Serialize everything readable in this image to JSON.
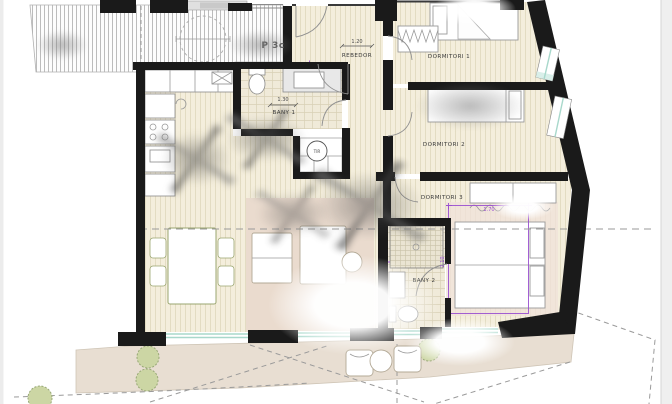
{
  "plan": {
    "unit_label": "P 3c",
    "labels": {
      "rebedor": "REBEDOR",
      "dormitori1": "DORMITORI 1",
      "dormitori2": "DORMITORI 2",
      "dormitori3": "DORMITORI 3",
      "bany1": "BANY 1",
      "bany2": "BANY 2",
      "tir": "TIR"
    },
    "dimensions": {
      "rebedor_window": "1.20",
      "bany1_width": "1.30",
      "dorm3_width": "1.70",
      "dorm3_depth": "2.10"
    }
  },
  "colors": {
    "wall": "#1a1a1a",
    "floor_wood": "#f4eedc",
    "floor_stripe": "#e3dcc2",
    "floor_tile": "#f0ead9",
    "terrace_deck": "#e8ded2",
    "rug": "#eadbce",
    "glazing": "#a8d8cb",
    "dimension_purple": "#9a4fd0",
    "bush_green": "#ccd6a4"
  }
}
